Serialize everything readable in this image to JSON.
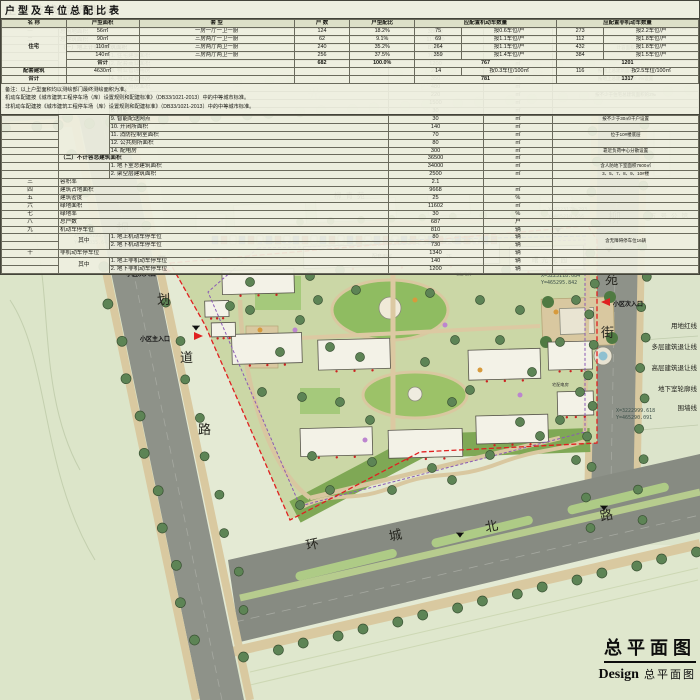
{
  "title_block": {
    "title": "总平面图",
    "design_en": "Design",
    "design_cn": "总平面图"
  },
  "compass": {
    "north_label": "N"
  },
  "scale_bar": {
    "labels": [
      "0",
      "20",
      "40",
      "60m"
    ]
  },
  "roads": {
    "top": {
      "name": "丹光西路",
      "chars": [
        "丹",
        "光",
        "西",
        "路"
      ]
    },
    "left": {
      "name": "规划道路",
      "chars": [
        "规",
        "划",
        "道",
        "路"
      ]
    },
    "right": {
      "name": "柳苑街",
      "chars": [
        "柳",
        "苑",
        "街"
      ]
    },
    "bottom": {
      "name": "环城北路",
      "chars": [
        "环",
        "城",
        "北",
        "路"
      ]
    }
  },
  "map_labels": {
    "neighborhood_top": "柳青苑",
    "garden_right": "曙光花园",
    "mansion_right": "五号公馆",
    "amenity_building": "配套用房",
    "amenity_floors": "2F",
    "power_room": "宅配电房"
  },
  "entrances": [
    {
      "label": "小区次入口"
    },
    {
      "label": "小区主入口"
    },
    {
      "label": "小区次入口"
    }
  ],
  "coordinates": [
    {
      "x": "X=3223192.756",
      "y": "Y=465035.643"
    },
    {
      "x": "X=3223175.293",
      "y": "Y=465210.656"
    },
    {
      "x": "X=3223118.084",
      "y": "Y=465295.842"
    },
    {
      "x": "X=3222999.618",
      "y": "Y=465290.091"
    }
  ],
  "legend": {
    "items": [
      "用地红线",
      "多层建筑退让线",
      "高层建筑退让线",
      "地下室轮廓线",
      "围墙线"
    ]
  },
  "indicators_table": {
    "title": "主要技术经济指标",
    "rows": [
      [
        {
          "t": "序号",
          "b": 1
        },
        {
          "t": "名  称",
          "cs": 2,
          "b": 1
        },
        {
          "t": "数 值",
          "b": 1
        },
        {
          "t": "单 位",
          "b": 1
        },
        {
          "t": "备  注",
          "b": 1
        }
      ],
      [
        "一",
        {
          "t": "总用地面积",
          "cs": 2,
          "l": 1
        },
        "38672",
        "㎡",
        ""
      ],
      [
        "二",
        {
          "t": "总建筑面积",
          "cs": 2,
          "l": 1
        },
        "117000",
        "㎡",
        ""
      ],
      [
        "",
        {
          "t": "（一）地上计容总建筑面积",
          "cs": 2,
          "l": 1,
          "b": 1
        },
        "81210",
        "㎡",
        {
          "t": "计容面积",
          "s": 1
        }
      ],
      [
        "",
        {
          "t": "其中",
          "rs": 13
        },
        {
          "t": "1. 住宅建筑面积",
          "l": 1
        },
        "76580",
        "㎡",
        ""
      ],
      [
        "",
        {
          "t": "2. 配套商业面积",
          "l": 1
        },
        "1200",
        "㎡",
        ""
      ],
      [
        "",
        {
          "t": "3. 物业管理用房",
          "l": 1
        },
        "240",
        "㎡",
        {
          "t": "按地上总建筑面积0.3%设置",
          "s": 1
        }
      ],
      [
        "",
        {
          "t": "4. 物业经营用房",
          "l": 1
        },
        "350",
        "㎡",
        {
          "t": "按地上总建筑面积0.4%设置",
          "s": 1
        }
      ],
      [
        "",
        {
          "t": "5. 社区用房面积",
          "l": 1
        },
        "480",
        "㎡",
        ""
      ],
      [
        "",
        {
          "t": "6. 养老服务用房",
          "l": 1
        },
        "220",
        "㎡",
        {
          "t": "按不少于住宅总建筑面积的2‰",
          "s": 1
        }
      ],
      [
        "",
        {
          "t": "7. 配套用房",
          "l": 1
        },
        "1500",
        "㎡",
        ""
      ],
      [
        "",
        {
          "t": "8. 门卫",
          "l": 1
        },
        "30",
        "㎡",
        ""
      ],
      [
        "",
        {
          "t": "9. 智能配送网点",
          "l": 1
        },
        "30",
        "㎡",
        {
          "t": "按不少于30㎡/千户设置",
          "s": 1
        }
      ],
      [
        "",
        {
          "t": "10. 开闭所面积",
          "l": 1
        },
        "140",
        "㎡",
        ""
      ],
      [
        "",
        {
          "t": "11. 消防控制室面积",
          "l": 1
        },
        "70",
        "㎡",
        {
          "t": "位于10#楼底层",
          "s": 1
        }
      ],
      [
        "",
        {
          "t": "12. 公共厕所面积",
          "l": 1
        },
        "80",
        "㎡",
        ""
      ],
      [
        "",
        {
          "t": "14. 配电房",
          "l": 1
        },
        "300",
        "㎡",
        {
          "t": "靠近负荷中心分散设置",
          "s": 1
        }
      ],
      [
        "",
        {
          "t": "（二）不计容总建筑面积",
          "cs": 2,
          "l": 1,
          "b": 1
        },
        "36500",
        "㎡",
        ""
      ],
      [
        "",
        "",
        {
          "t": "1. 地下室总建筑面积",
          "l": 1
        },
        "34000",
        "㎡",
        {
          "t": "含人防地下室面积7600㎡",
          "s": 1
        }
      ],
      [
        "",
        "",
        {
          "t": "2. 架空层建筑面积",
          "l": 1
        },
        "2500",
        "㎡",
        {
          "t": "3、5、7、8、9、10#楼",
          "s": 1
        }
      ],
      [
        "三",
        {
          "t": "容积率",
          "cs": 2,
          "l": 1
        },
        "2.1",
        "",
        ""
      ],
      [
        "四",
        {
          "t": "建筑占地面积",
          "cs": 2,
          "l": 1
        },
        "9668",
        "㎡",
        ""
      ],
      [
        "五",
        {
          "t": "建筑密度",
          "cs": 2,
          "l": 1
        },
        "25",
        "%",
        ""
      ],
      [
        "六",
        {
          "t": "绿地面积",
          "cs": 2,
          "l": 1
        },
        "11602",
        "㎡",
        ""
      ],
      [
        "七",
        {
          "t": "绿地率",
          "cs": 2,
          "l": 1
        },
        "30",
        "%",
        ""
      ],
      [
        "八",
        {
          "t": "总户数",
          "cs": 2,
          "l": 1
        },
        "687",
        "户",
        ""
      ],
      [
        "九",
        {
          "t": "机动车停车位",
          "cs": 2,
          "l": 1
        },
        "810",
        "辆",
        ""
      ],
      [
        "",
        {
          "t": "其中",
          "rs": 2
        },
        {
          "t": "1. 地上机动车停车位",
          "l": 1
        },
        "80",
        "辆",
        {
          "t": "含无障碍停车位16辆",
          "rs": 2,
          "s": 1
        }
      ],
      [
        "",
        {
          "t": "2. 地下机动车停车位",
          "l": 1
        },
        "730",
        "辆"
      ],
      [
        "十",
        {
          "t": "非机动车停车位",
          "cs": 2,
          "l": 1
        },
        "1340",
        "辆",
        ""
      ],
      [
        "",
        {
          "t": "其中",
          "rs": 2
        },
        {
          "t": "1. 地上非机动车停车位",
          "l": 1
        },
        "140",
        "辆",
        ""
      ],
      [
        "",
        {
          "t": "2. 地下非机动车停车位",
          "l": 1
        },
        "1200",
        "辆",
        ""
      ]
    ]
  },
  "parking_table": {
    "title": "户型及车位总配比表",
    "rows": [
      [
        {
          "t": "名 称",
          "b": 1
        },
        {
          "t": "户型面积",
          "b": 1
        },
        {
          "t": "套  型",
          "b": 1
        },
        {
          "t": "户 数",
          "b": 1
        },
        {
          "t": "户型配比",
          "b": 1
        },
        {
          "t": "应配置机动车数量",
          "cs": 2,
          "b": 1
        },
        {
          "t": "应配置非机动车数量",
          "cs": 2,
          "b": 1
        }
      ],
      [
        {
          "t": "住宅",
          "rs": 5,
          "b": 1
        },
        "56㎡",
        "一房一厅一卫一厨",
        "124",
        "18.2%",
        "75",
        "按0.6车位/户",
        "273",
        "按2.2车位/户"
      ],
      [
        "90㎡",
        "三房两厅一卫一厨",
        "62",
        "9.1%",
        "69",
        "按1.1车位/户",
        "112",
        "按1.8车位/户"
      ],
      [
        "110㎡",
        "三房两厅两卫一厨",
        "240",
        "35.2%",
        "264",
        "按1.1车位/户",
        "432",
        "按1.8车位/户"
      ],
      [
        "140㎡",
        "三房两厅两卫一厨",
        "256",
        "37.5%",
        "359",
        "按1.4车位/户",
        "384",
        "按1.5车位/户"
      ],
      [
        {
          "t": "合计",
          "b": 1
        },
        "",
        {
          "t": "682",
          "b": 1
        },
        {
          "t": "100.0%",
          "b": 1
        },
        {
          "t": "767",
          "cs": 2,
          "b": 1
        },
        {
          "t": "1201",
          "cs": 2,
          "b": 1
        }
      ],
      [
        {
          "t": "配套建筑",
          "b": 1
        },
        "4630㎡",
        "",
        "",
        "",
        "14",
        "按0.3车位/100㎡",
        "116",
        "按2.5车位/100㎡"
      ],
      [
        {
          "t": "合计",
          "b": 1
        },
        "",
        "",
        "",
        "",
        {
          "t": "781",
          "cs": 2,
          "b": 1
        },
        {
          "t": "1317",
          "cs": 2,
          "b": 1
        }
      ]
    ],
    "notes": [
      "备注：以上户型面积均以测绘部门最终测绘面积为准。",
      "机动车配建按《城市建筑工程停车场（库）设置规则和配建标准》（DB33/1021-2013）中的中等城市标准。",
      "非机动车配建按《城市建筑工程停车场（库）设置规则和配建标准》（DB33/1021-2013）中的中等城市标准。"
    ]
  },
  "colors": {
    "boundary_red": "#e02020",
    "basement_purple": "#8a5bb5",
    "setback_blue": "#4466cc",
    "road_grey": "#8e9289"
  }
}
